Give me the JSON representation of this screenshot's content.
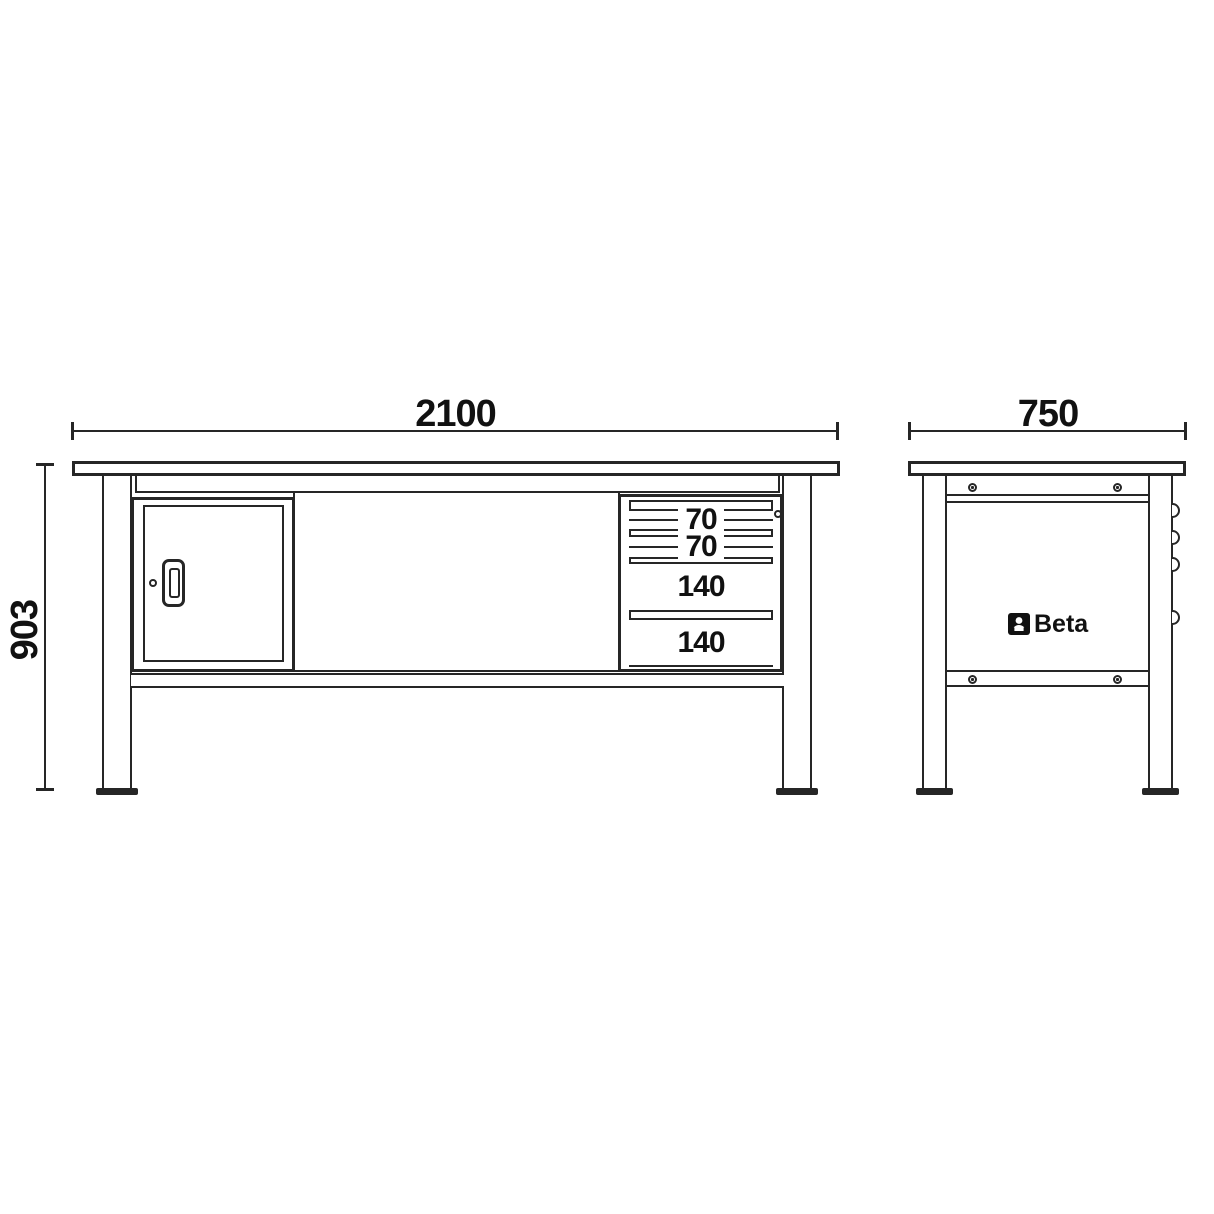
{
  "dimensions": {
    "front_width": "2100",
    "height": "903",
    "side_depth": "750"
  },
  "front_view": {
    "drawers": [
      {
        "label": "70"
      },
      {
        "label": "70"
      },
      {
        "label": "140"
      },
      {
        "label": "140"
      }
    ]
  },
  "side_view": {
    "logo_text": "Beta"
  },
  "colors": {
    "line": "#262626",
    "text": "#111111",
    "background": "#ffffff"
  }
}
